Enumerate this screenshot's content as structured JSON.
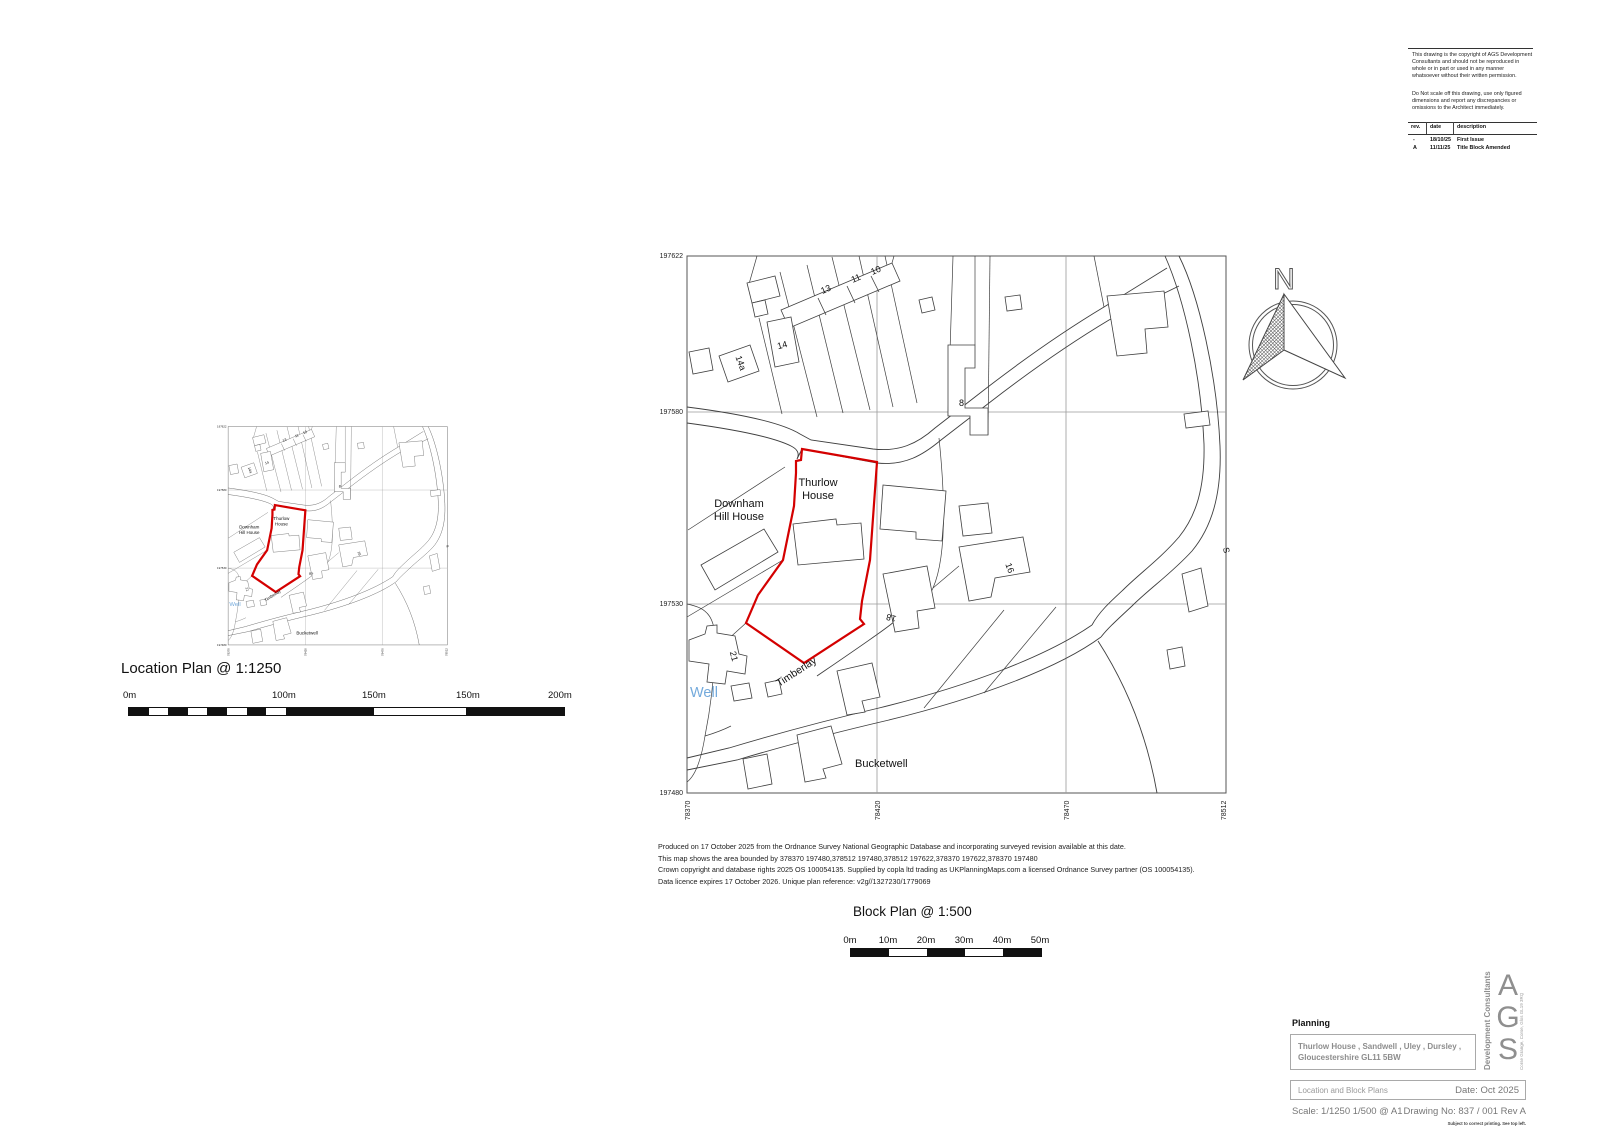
{
  "copyright_block": {
    "para1": "This drawing is the copyright of AGS Development Consultants and should not be reproduced in whole or in part or used in any manner whatsoever without their written permission.",
    "para2": "Do Not scale off this drawing, use only figured dimensions and report any discrepancies or omissions to the Architect immediately.",
    "rev_table": {
      "headers": [
        "rev.",
        "date",
        "description"
      ],
      "rows": [
        [
          "-",
          "18/10/25",
          "First Issue"
        ],
        [
          "A",
          "11/11/25",
          "Title Block Amended"
        ]
      ]
    }
  },
  "north_arrow": {
    "label": "N"
  },
  "location_plan": {
    "title": "Location Plan @ 1:1250",
    "scale_labels": [
      "0m",
      "100m",
      "150m",
      "150m",
      "200m"
    ]
  },
  "block_plan": {
    "title": "Block Plan @ 1:500",
    "scale_labels": [
      "0m",
      "10m",
      "20m",
      "30m",
      "40m",
      "50m"
    ],
    "axis": {
      "left": [
        "197622",
        "197580",
        "197530",
        "197480"
      ],
      "bottom": [
        "378370",
        "378420",
        "378470",
        "378512"
      ]
    },
    "map_labels": {
      "thurlow_l1": "Thurlow",
      "thurlow_l2": "House",
      "downham_l1": "Downham",
      "downham_l2": "Hill House",
      "timberlay": "Timberlay",
      "well": "Well",
      "bucketwell": "Bucketwell",
      "road_s": "S",
      "n13": "13",
      "n11": "11",
      "n10": "10",
      "n14": "14",
      "n14a": "14a",
      "n8": "8",
      "n16": "16",
      "n18": "18",
      "n21": "21"
    }
  },
  "os_attribution": {
    "line1": "Produced on 17 October 2025 from the Ordnance Survey National Geographic Database and incorporating surveyed revision available at this date.",
    "line2": "This map shows the area bounded by 378370 197480,378512 197480,378512 197622,378370 197622,378370 197480",
    "line3": "Crown copyright and database rights 2025 OS 100054135. Supplied by copla ltd trading as UKPlanningMaps.com a licensed Ordnance Survey partner (OS 100054135).",
    "line4": "Data licence expires 17 October 2026. Unique plan reference: v2g//1327230/1779069"
  },
  "title_block": {
    "section": "Planning",
    "address_line1": "Thurlow House , Sandwell , Uley , Dursley ,",
    "address_line2": "Gloucestershire GL11 5BW",
    "drawing_title": "Location and Block Plans",
    "date": "Date: Oct 2025",
    "scale": "Scale:   1/1250 1/500 @ A1",
    "drawing_no": "Drawing No: 837 / 001 Rev A",
    "logo_letter_a": "A",
    "logo_letter_g": "G",
    "logo_letter_s": "S",
    "logo_side": "Development Consultants",
    "logo_address": "Corse Grange, Corse, Glos GL19 3RQ",
    "print_note": "Subject to correct printing. See top left."
  },
  "colors": {
    "site_boundary": "#d40000",
    "water_label": "#74aadc",
    "map_line": "#3f3f3f",
    "grid_line": "#9a9a9a"
  }
}
